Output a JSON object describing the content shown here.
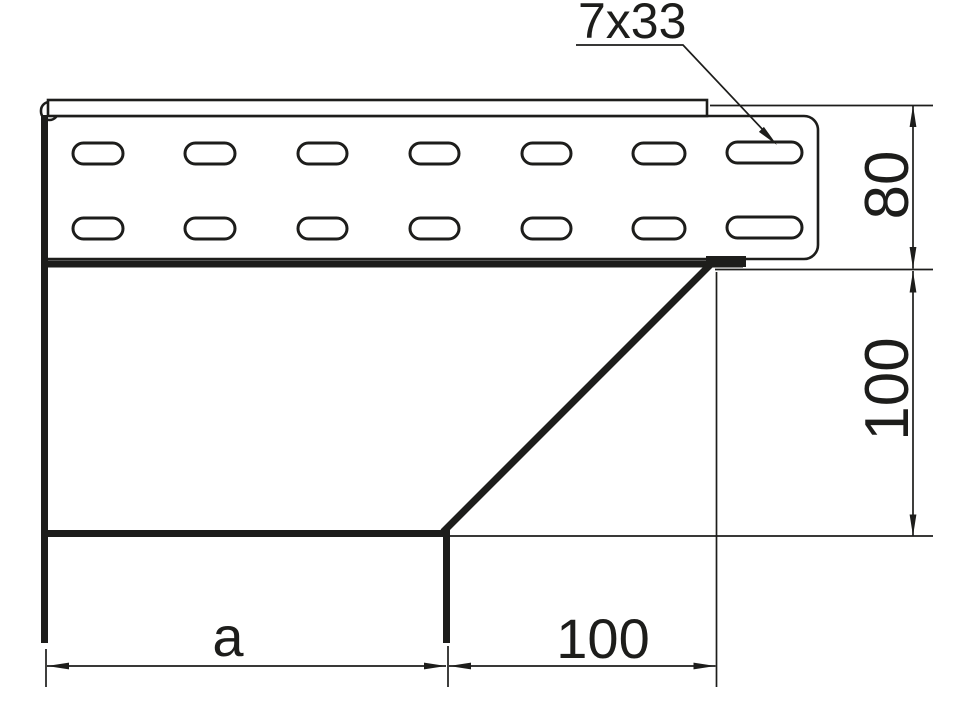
{
  "drawing": {
    "kind": "cable-tray-riser-technical-drawing",
    "background": "#ffffff",
    "line_color": "#1d1d1b",
    "labels": {
      "slot_callout": "7x33",
      "rail_height": "80",
      "riser_height": "100",
      "base_width": "a",
      "offset_width": "100"
    }
  }
}
